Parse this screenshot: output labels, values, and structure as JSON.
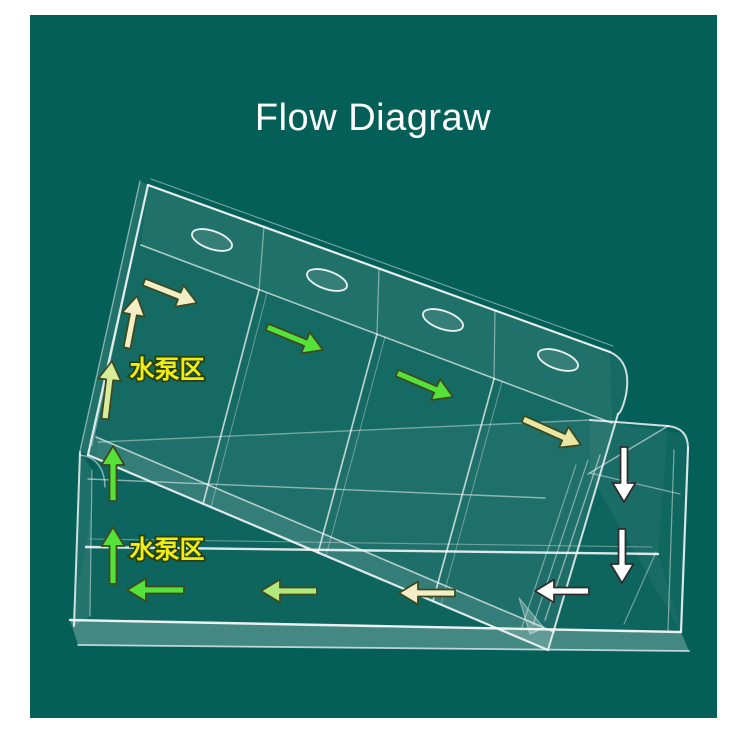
{
  "page": {
    "background_color": "#ffffff"
  },
  "photo": {
    "background_color": "#045f58",
    "x": 30,
    "y": 15,
    "width": 687,
    "height": 703
  },
  "title": {
    "text": "Flow Diagraw",
    "color": "#fdfdfd",
    "font_size": 38
  },
  "pump_area_labels": [
    {
      "name": "pump-area-label-top",
      "text": "水泵区",
      "x": 167,
      "y": 378
    },
    {
      "name": "pump-area-label-bottom",
      "text": "水泵区",
      "x": 167,
      "y": 558
    }
  ],
  "label_style": {
    "fill": "#f0ec14",
    "outline": "#27400a",
    "font_size": 25
  },
  "arrow_style": {
    "shaft_width": 7,
    "head_width": 23,
    "head_length": 19,
    "outline_colored": "#3c4a20",
    "outline_white": "#2e2e2e",
    "outline_width": 1.8
  },
  "colors": {
    "cream": "#f3eec6",
    "khaki": "#e9e5a2",
    "pale_green_yellow": "#d9ec9a",
    "pale_green": "#b3e97c",
    "green": "#55e138",
    "white": "#ffffff"
  },
  "arrows": [
    {
      "name": "arrow-tray-pump-diagonal",
      "color": "cream",
      "direction": "right-down",
      "tail": [
        144,
        282
      ],
      "tip": [
        197,
        303
      ]
    },
    {
      "name": "arrow-tray-pump-up",
      "color": "cream",
      "direction": "up",
      "tail": [
        127,
        348
      ],
      "tip": [
        137,
        296
      ]
    },
    {
      "name": "arrow-tray-pump-up-lower",
      "color": "pale_green_yellow",
      "direction": "up",
      "tail": [
        105,
        419
      ],
      "tip": [
        112,
        361
      ]
    },
    {
      "name": "arrow-tray-compartment-2",
      "color": "green",
      "direction": "right-down",
      "tail": [
        267,
        327
      ],
      "tip": [
        323,
        350
      ]
    },
    {
      "name": "arrow-tray-compartment-3",
      "color": "green",
      "direction": "right-down",
      "tail": [
        397,
        373
      ],
      "tip": [
        453,
        397
      ]
    },
    {
      "name": "arrow-tray-compartment-4",
      "color": "khaki",
      "direction": "right-down",
      "tail": [
        523,
        419
      ],
      "tip": [
        581,
        445
      ]
    },
    {
      "name": "arrow-box-right-down-upper",
      "color": "white",
      "direction": "down",
      "tail": [
        624,
        447
      ],
      "tip": [
        624,
        502
      ]
    },
    {
      "name": "arrow-box-right-down-lower",
      "color": "white",
      "direction": "down",
      "tail": [
        622,
        529
      ],
      "tip": [
        622,
        583
      ]
    },
    {
      "name": "arrow-box-bottom-left-1",
      "color": "white",
      "direction": "left",
      "tail": [
        589,
        591
      ],
      "tip": [
        535,
        591
      ]
    },
    {
      "name": "arrow-box-bottom-left-2",
      "color": "cream",
      "direction": "left",
      "tail": [
        455,
        593
      ],
      "tip": [
        399,
        593
      ]
    },
    {
      "name": "arrow-box-bottom-left-3",
      "color": "pale_green",
      "direction": "left",
      "tail": [
        317,
        591
      ],
      "tip": [
        261,
        591
      ]
    },
    {
      "name": "arrow-box-bottom-left-4",
      "color": "green",
      "direction": "left",
      "tail": [
        184,
        590
      ],
      "tip": [
        127,
        590
      ]
    },
    {
      "name": "arrow-box-left-up-lower",
      "color": "green",
      "direction": "up",
      "tail": [
        113,
        584
      ],
      "tip": [
        113,
        527
      ]
    },
    {
      "name": "arrow-box-left-up-upper",
      "color": "green",
      "direction": "up",
      "tail": [
        113,
        501
      ],
      "tip": [
        113,
        446
      ]
    }
  ]
}
